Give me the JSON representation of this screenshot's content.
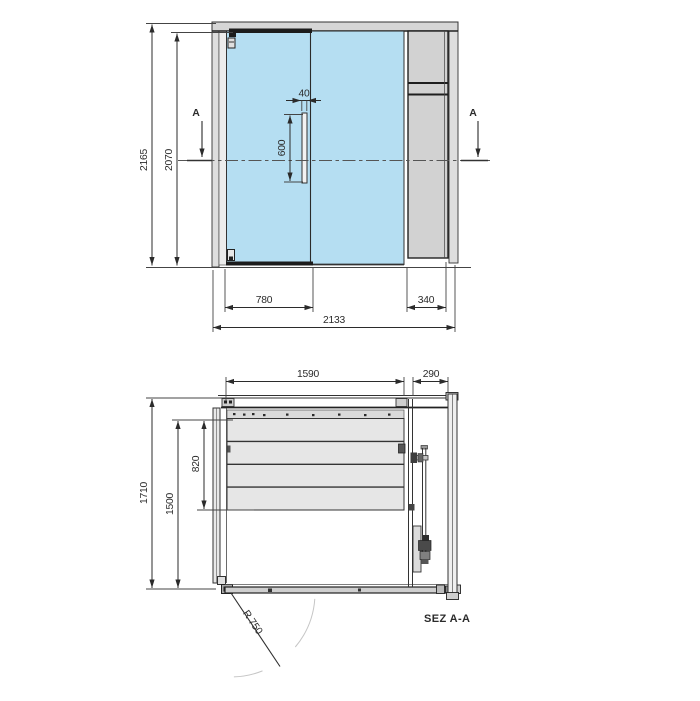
{
  "drawing": {
    "type": "technical drawing - glass cabin front elevation and plan section",
    "colors": {
      "glass": "#b5def2",
      "panel": "#d2d2d2",
      "frame_light": "#dedede",
      "bench": "#e6e6e6",
      "track": "#cfcfcf",
      "line": "#333333",
      "faint_arc": "#c5c5c5"
    },
    "elevation": {
      "section_marker": "A",
      "dims": {
        "overall_height": "2165",
        "door_height": "2070",
        "handle_width": "40",
        "handle_length": "600",
        "door_width": "780",
        "side_panel_width": "340",
        "overall_width": "2133"
      }
    },
    "plan": {
      "label": "SEZ A-A",
      "dims": {
        "interior_width": "1590",
        "tech_compartment_width": "290",
        "overall_depth": "1710",
        "interior_depth": "1500",
        "bench_depth": "820",
        "door_swing_radius": "R 750"
      }
    }
  }
}
